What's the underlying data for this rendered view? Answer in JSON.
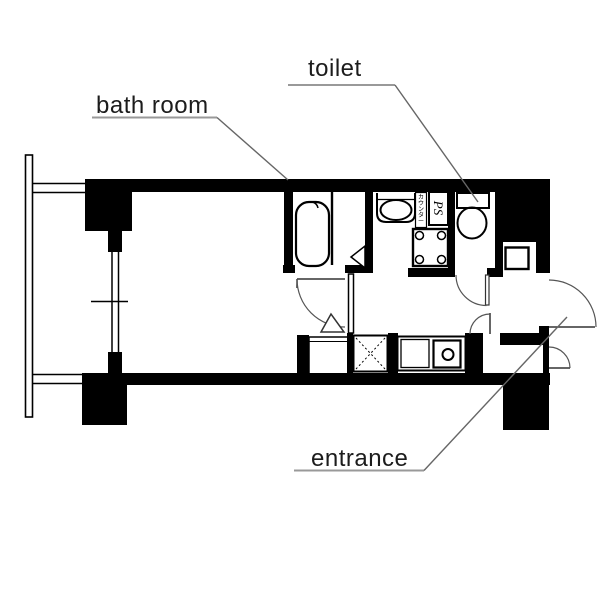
{
  "labels": {
    "bath_room": "bath room",
    "toilet": "toilet",
    "entrance": "entrance",
    "ps": "PS",
    "counter": "カウンター"
  },
  "colors": {
    "walls": "#000000",
    "fixture_line": "#000000",
    "leader_line": "#666666",
    "underline": "#999999",
    "background": "#ffffff"
  }
}
